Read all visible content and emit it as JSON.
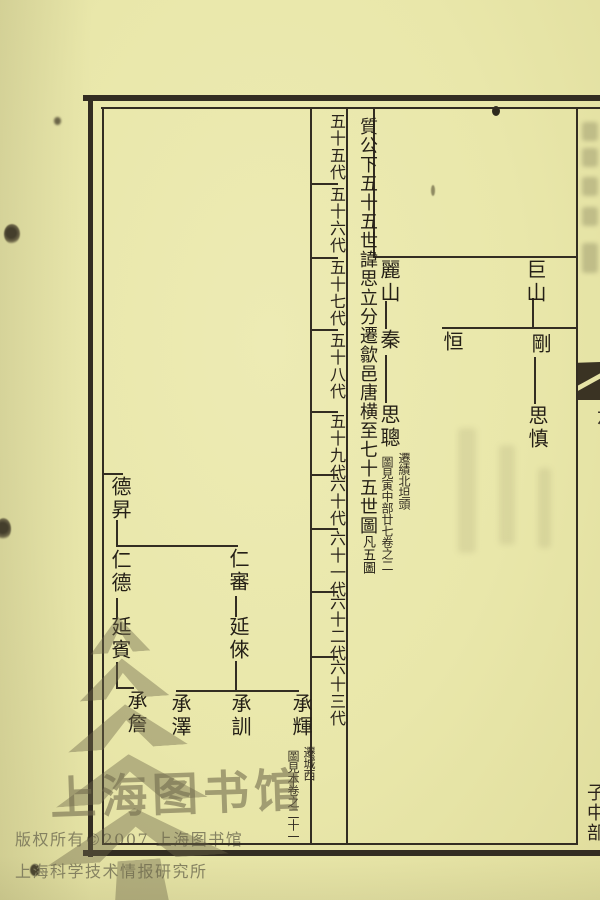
{
  "colors": {
    "paper": "#eae8ac",
    "ink": "#332d22",
    "watermark_gray": "#6e684a"
  },
  "chart": {
    "title": {
      "main": "質公下五十五世諱思立分遷歙邑唐横至七十五世圖",
      "note": "凡五圖"
    },
    "generation_labels": [
      "五十五代",
      "五十六代",
      "五十七代",
      "五十八代",
      "五十九代",
      "六十代",
      "六十一代",
      "六十二代",
      "六十三代"
    ],
    "persons": [
      {
        "name": "麗山"
      },
      {
        "name": "秦"
      },
      {
        "name": "思聰",
        "note_right": "遷績北坦頭",
        "note_left": "圖見寅中部廿七卷之二"
      },
      {
        "name": "巨山"
      },
      {
        "name": "恒"
      },
      {
        "name": "剛"
      },
      {
        "name": "思慎"
      },
      {
        "name": "德昇"
      },
      {
        "name": "仁德"
      },
      {
        "name": "延賓"
      },
      {
        "name": "承詹"
      },
      {
        "name": "仁審"
      },
      {
        "name": "延倈"
      },
      {
        "name": "承澤"
      },
      {
        "name": "承訓"
      },
      {
        "name": "承輝",
        "note_right": "遷城西",
        "note_left": "圖見本卷之二十一"
      }
    ]
  },
  "margin": {
    "volume_column": "旌德邑新建",
    "partial_char": "六",
    "section_label": "子中部"
  },
  "watermark": {
    "calligraphy": "上海图书馆",
    "copyright_line1": "版权所有©2007 上海图书馆",
    "copyright_line2": "上海科学技术情报研究所"
  }
}
